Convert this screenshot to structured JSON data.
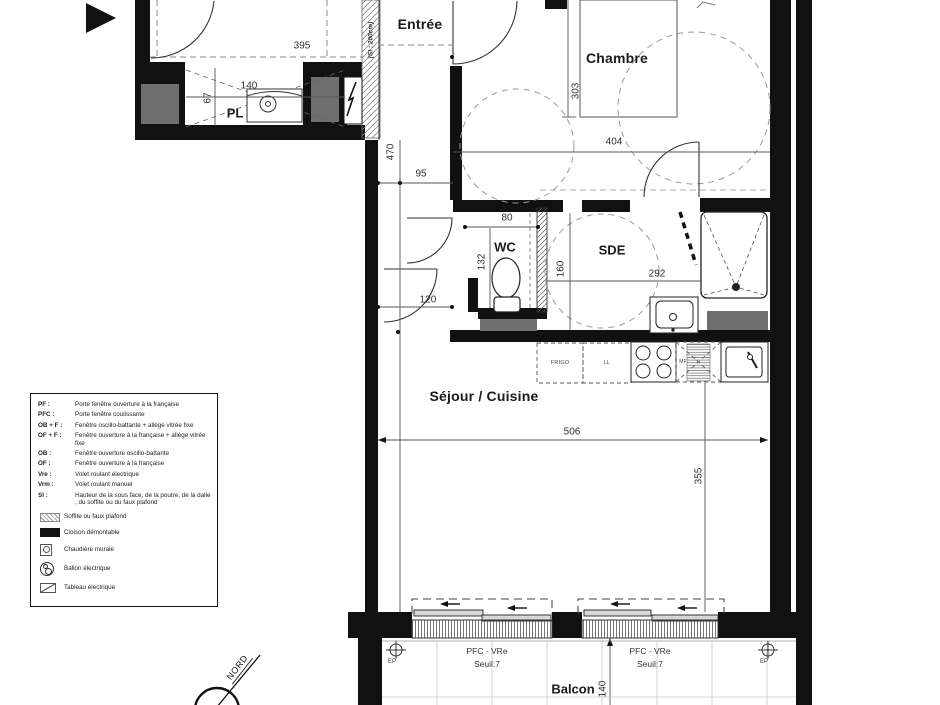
{
  "rooms": {
    "entree": "Entrée",
    "chambre": "Chambre",
    "wc": "WC",
    "sde": "SDE",
    "sejour": "Séjour / Cuisine",
    "balcon": "Balcon",
    "pl": "PL"
  },
  "appliances": {
    "frigo": "FRIGO",
    "lavelinge": "LL",
    "mf": "MF"
  },
  "dims": {
    "d395": "395",
    "d140pl": "140",
    "d67": "67",
    "d470": "470",
    "d95": "95",
    "d303": "303",
    "d404": "404",
    "d80": "80",
    "d132": "132",
    "d120": "120",
    "d160": "160",
    "d292": "292",
    "d506": "506",
    "d355": "355",
    "d140balcon": "140"
  },
  "windows": {
    "w1_type": "PFC - VRe",
    "w1_seuil": "Seuil:7",
    "w2_type": "PFC - VRe",
    "w2_seuil": "Seuil:7",
    "ep_left": "EP",
    "ep_right": "EP"
  },
  "soffit_note": "(SI : 200cm)",
  "compass": {
    "north": "NORD"
  },
  "legend": {
    "items": [
      {
        "abbr": "PF :",
        "text": "Porte fenêtre ouverture à la française"
      },
      {
        "abbr": "PFC :",
        "text": "Porte fenêtre coulissante"
      },
      {
        "abbr": "OB + F :",
        "text": "Fenêtre oscillo-battante + allège vitrée fixe"
      },
      {
        "abbr": "OF + F :",
        "text": "Fenêtre ouverture à la française + allège vitrée fixe"
      },
      {
        "abbr": "OB :",
        "text": "Fenêtre ouverture oscillo-battante"
      },
      {
        "abbr": "OF :",
        "text": "Fenêtre ouverture à la française"
      },
      {
        "abbr": "Vre :",
        "text": "Volet roulant électrique"
      },
      {
        "abbr": "Vrm :",
        "text": "Volet roulant manuel"
      },
      {
        "abbr": "SI :",
        "text": "Hauteur de la sous face, de la poutre, de la dalle , du soffite ou du faux plafond"
      }
    ],
    "symbols": [
      {
        "text": "Soffite ou faux plafond"
      },
      {
        "text": "Cloison démontable"
      },
      {
        "text": "Chaudière murale"
      },
      {
        "text": "Ballon électrique"
      },
      {
        "text": "Tableau électrique"
      }
    ]
  },
  "colors": {
    "wall": "#111111",
    "shaft_gray": "#6f6f6f",
    "line": "#333333"
  }
}
